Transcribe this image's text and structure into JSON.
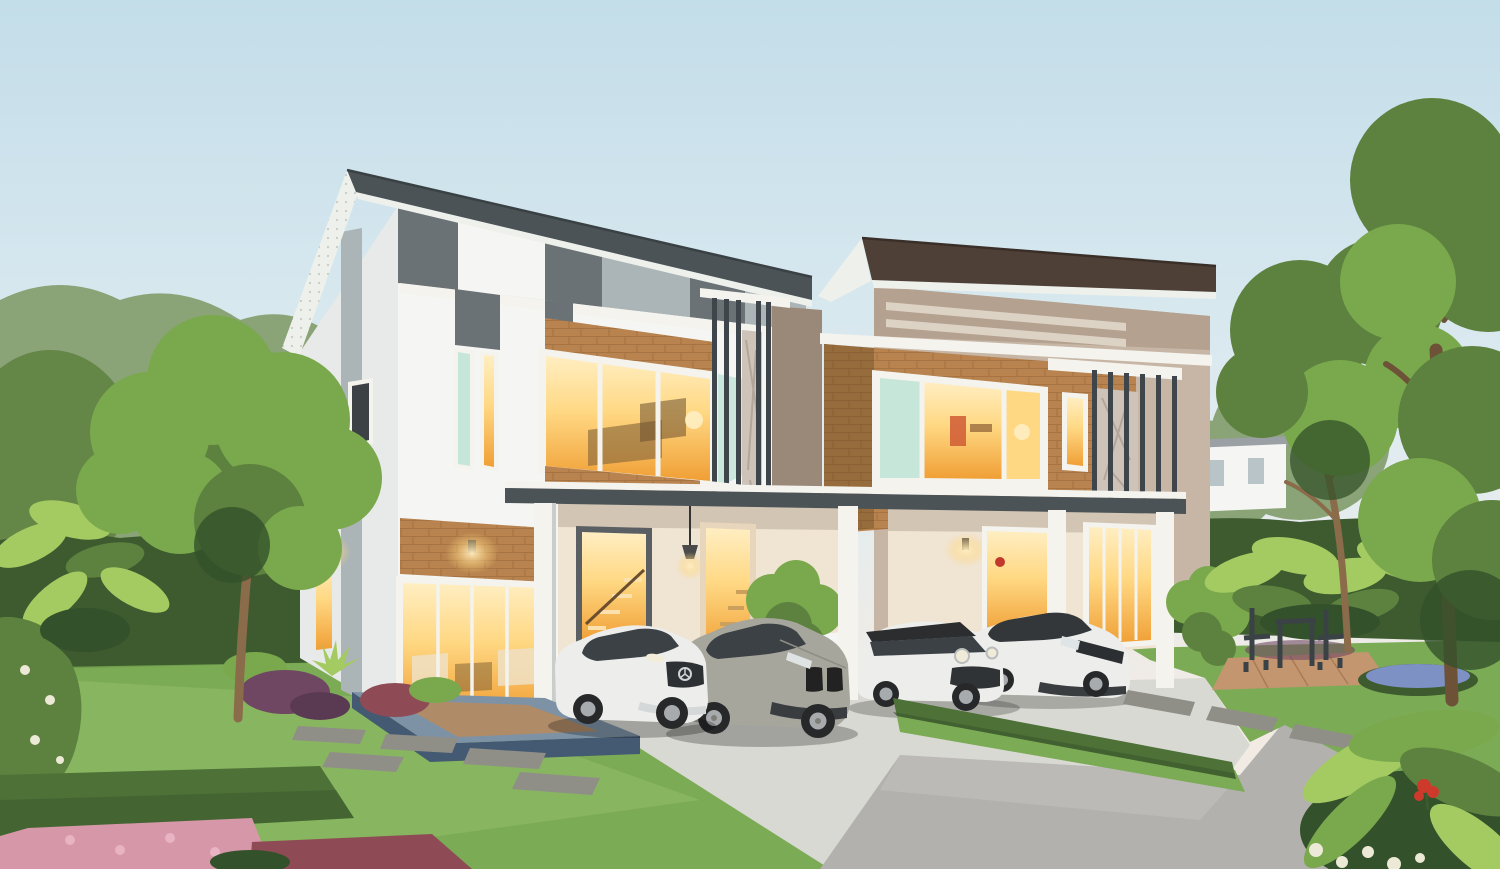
{
  "meta": {
    "title": "Twin two-storey modern houses with carports, four cars and landscaped garden at dusk",
    "medium": "real-estate architectural rendering",
    "visible_text": "none"
  },
  "palette": {
    "sky-top": "#c3dde9",
    "sky-mid": "#e0ecf1",
    "sky-horizon": "#f2ebe4",
    "tree-muted": "#8aa377",
    "tree-dark": "#41602f",
    "tree-mid": "#5d813e",
    "tree-bright": "#7aa94d",
    "tree-deep": "#33512a",
    "hedge-dark": "#3d5b2f",
    "hedge-mid": "#4e7137",
    "lawn": "#7cab56",
    "lawn-light": "#94c067",
    "lawn-dark": "#608d42",
    "trunk": "#8a6b4a",
    "trunk-dark": "#6d5238",
    "leaf-big": "#a4ca62",
    "wall-white": "#f5f6f3",
    "wall-shade": "#e7eae8",
    "gray-side": "#b5bcbd",
    "panel-dark": "#6a7276",
    "panel-light": "#abb4b6",
    "fascia-gray": "#4b5357",
    "soffit": "#eef0eb",
    "soffit-dot": "#c6ccc5",
    "taupe": "#b4a190",
    "taupe-light": "#c7b6a5",
    "taupe-dark": "#9a8878",
    "cream": "#ddd3c5",
    "fascia-brown": "#4e4037",
    "brick": "#b8834e",
    "brick-dark": "#97683b",
    "ledge": "#f4f3ee",
    "louver": "#3e454b",
    "glow": "#f09f35",
    "glow-soft": "#ffd883",
    "glow-pale": "#ffeec2",
    "teal": "#c6e6da",
    "glass-dark": "#3c4145",
    "concrete": "#d9d9d3",
    "road": "#b2b1ad",
    "road-light": "#c7c6c1",
    "porch-top": "#7e92a6",
    "porch-side": "#445972",
    "porch-wood": "#bd8a58",
    "stone": "#8f8f88",
    "clay": "#c4966f",
    "car-white": "#edeeec",
    "car-white-dk": "#c9cecd",
    "car-silver": "#a7a69d",
    "car-silver-dk": "#7f7f79",
    "tire": "#26282a",
    "rim": "#a8abad",
    "cream-wall": "#f0e4d2",
    "stair": "#f2b050",
    "fl-pink": "#d697a9",
    "fl-red": "#cd3a2b",
    "fl-maroon": "#8e4b55",
    "fl-purple": "#6f4763",
    "fl-blue": "#7e91c5",
    "fl-white": "#ecead6"
  },
  "scene": {
    "setting": "dusk, warm interior lights on",
    "houses": [
      {
        "id": "left-house",
        "scheme": "white walls with gray panel band",
        "fascia": "dark gray slanted roof",
        "accent": "brick panels above windows",
        "storeys": 2,
        "windows_lit": true,
        "carport": true
      },
      {
        "id": "right-house",
        "scheme": "taupe walls with cream stripes",
        "fascia": "dark brown slanted roof",
        "accent": "brick corner and metal louver screen",
        "storeys": 2,
        "windows_lit": true,
        "carport": true
      }
    ],
    "cars": [
      {
        "id": "white-luxury-coupe",
        "body_color": "white",
        "position": "left carport, left"
      },
      {
        "id": "silver-sports-coupe",
        "body_color": "silver",
        "position": "left carport, right"
      },
      {
        "id": "white-mini-hatchback",
        "body_color": "white",
        "roof_color": "black",
        "position": "right carport, left"
      },
      {
        "id": "white-compact-sedan",
        "body_color": "white",
        "roof_color": "dark gray",
        "position": "right carport, right"
      }
    ],
    "landscape": {
      "front_lawn": true,
      "stepping_stones": true,
      "driveways": 2,
      "hedge_walls": "clipped hedge walls both sides",
      "trees": "mature trees left and right, tall tree at right edge",
      "tropical_plants": "large-leaf plants by hedges and in foreground corner",
      "flower_beds": [
        "pink",
        "maroon",
        "blue",
        "white",
        "red"
      ],
      "garden_furniture": "dark metal chairs and table on clay paver patio in right garden",
      "porch": "blue-gray tiled entrance platform with wood inlay"
    }
  }
}
